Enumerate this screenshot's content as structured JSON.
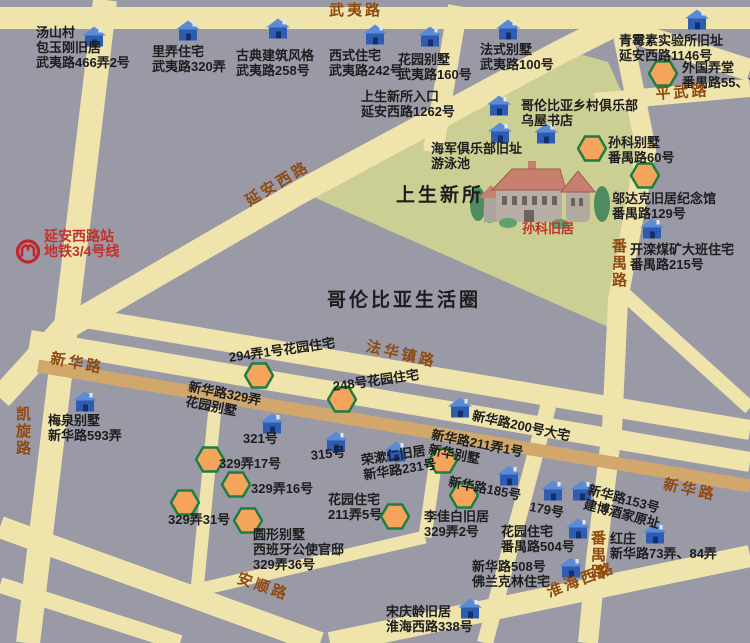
{
  "colors": {
    "background": "#9a9aa7",
    "road": "#f0e4ad",
    "xinhua_road": "#d2a76b",
    "park": "#cccf93",
    "road_label": "#8f4a10",
    "poi_label": "#1d1d1d",
    "red_label": "#c0312b",
    "house_blue": "#2e5cb0",
    "house_roof": "#5b8ad6",
    "hexagon_fill": "#f5a45c",
    "hexagon_border": "#1c7f41",
    "metro_red": "#c0272d",
    "illustration_roof": "#c8806e",
    "illustration_wall": "#b7aea6",
    "tree_green": "#4e8b5f"
  },
  "map": {
    "labels": [
      {
        "name": "poi-baoyugang",
        "lines": [
          "汤山村",
          "包玉刚旧居",
          "武夷路466弄2号"
        ],
        "x": 36,
        "y": 25,
        "kind": "poi"
      },
      {
        "name": "poi-lilong",
        "lines": [
          "里弄住宅",
          "武夷路320弄"
        ],
        "x": 152,
        "y": 44,
        "kind": "poi"
      },
      {
        "name": "poi-gudian",
        "lines": [
          "古典建筑风格",
          "武夷路258号"
        ],
        "x": 236,
        "y": 48,
        "kind": "poi"
      },
      {
        "name": "poi-xishi",
        "lines": [
          "西式住宅",
          "武夷路242号"
        ],
        "x": 329,
        "y": 48,
        "kind": "poi"
      },
      {
        "name": "poi-huayuan-160",
        "lines": [
          "花园别墅",
          "武夷路160号"
        ],
        "x": 398,
        "y": 52,
        "kind": "poi"
      },
      {
        "name": "poi-fashi",
        "lines": [
          "法式别墅",
          "武夷路100号"
        ],
        "x": 480,
        "y": 42,
        "kind": "poi"
      },
      {
        "name": "poi-qingmeisu",
        "lines": [
          "青霉素实验所旧址",
          "延安西路1146号"
        ],
        "x": 619,
        "y": 33,
        "kind": "poi"
      },
      {
        "name": "poi-waiguo-longtang",
        "lines": [
          "外国弄堂",
          "番禺路55、7"
        ],
        "x": 682,
        "y": 60,
        "kind": "poi"
      },
      {
        "name": "poi-entrance",
        "lines": [
          "上生新所入口",
          "延安西路1262号"
        ],
        "x": 361,
        "y": 89,
        "kind": "poi"
      },
      {
        "name": "poi-columbia-club",
        "lines": [
          "哥伦比亚乡村俱乐部",
          "乌屋书店"
        ],
        "x": 521,
        "y": 98,
        "kind": "poi"
      },
      {
        "name": "poi-navy-club",
        "lines": [
          "海军俱乐部旧址",
          "游泳池"
        ],
        "x": 431,
        "y": 141,
        "kind": "poi"
      },
      {
        "name": "poi-sunke-villa",
        "lines": [
          "孙科别墅",
          "番禺路60号"
        ],
        "x": 608,
        "y": 135,
        "kind": "poi"
      },
      {
        "name": "poi-wudake",
        "lines": [
          "邬达克旧居纪念馆",
          "番禺路129号"
        ],
        "x": 612,
        "y": 191,
        "kind": "poi"
      },
      {
        "name": "poi-kailuan",
        "lines": [
          "开滦煤矿大班住宅",
          "番禺路215号"
        ],
        "x": 630,
        "y": 242,
        "kind": "poi"
      },
      {
        "name": "poi-meiquan",
        "lines": [
          "梅泉别墅",
          "新华路593弄"
        ],
        "x": 48,
        "y": 413,
        "kind": "poi"
      },
      {
        "name": "poi-294-1",
        "lines": [
          "294弄1号花园住宅"
        ],
        "x": 228,
        "y": 350,
        "kind": "poi",
        "rotate": -8
      },
      {
        "name": "poi-248",
        "lines": [
          "248号花园住宅"
        ],
        "x": 332,
        "y": 379,
        "kind": "poi",
        "rotate": -8
      },
      {
        "name": "poi-329nong",
        "lines": [
          "新华路329弄",
          "花园别墅"
        ],
        "x": 190,
        "y": 379,
        "kind": "poi",
        "rotate": 11
      },
      {
        "name": "poi-321",
        "lines": [
          "321号"
        ],
        "x": 243,
        "y": 431,
        "kind": "poi"
      },
      {
        "name": "poi-315",
        "lines": [
          "315号"
        ],
        "x": 310,
        "y": 448,
        "kind": "poi",
        "rotate": -6
      },
      {
        "name": "poi-rongshuren",
        "lines": [
          "荣漱仁旧居",
          "新华路231号"
        ],
        "x": 360,
        "y": 453,
        "kind": "poi",
        "rotate": -9
      },
      {
        "name": "poi-329-17",
        "lines": [
          "329弄17号"
        ],
        "x": 219,
        "y": 456,
        "kind": "poi"
      },
      {
        "name": "poi-329-16",
        "lines": [
          "329弄16号"
        ],
        "x": 251,
        "y": 481,
        "kind": "poi"
      },
      {
        "name": "poi-329-31",
        "lines": [
          "329弄31号"
        ],
        "x": 168,
        "y": 512,
        "kind": "poi"
      },
      {
        "name": "poi-329-36",
        "lines": [
          "圆形别墅",
          "西班牙公使官邸",
          "329弄36号"
        ],
        "x": 253,
        "y": 527,
        "kind": "poi"
      },
      {
        "name": "poi-211-5",
        "lines": [
          "花园住宅",
          "211弄5号"
        ],
        "x": 328,
        "y": 492,
        "kind": "poi"
      },
      {
        "name": "poi-lijiabai",
        "lines": [
          "李佳白旧居",
          "329弄2号"
        ],
        "x": 424,
        "y": 509,
        "kind": "poi"
      },
      {
        "name": "poi-xinhua-villa",
        "lines": [
          "新华路211弄1号",
          "新华别墅"
        ],
        "x": 433,
        "y": 427,
        "kind": "poi",
        "rotate": 11
      },
      {
        "name": "poi-185",
        "lines": [
          "新华路185号"
        ],
        "x": 450,
        "y": 474,
        "kind": "poi",
        "rotate": 11
      },
      {
        "name": "poi-179",
        "lines": [
          "179号"
        ],
        "x": 531,
        "y": 499,
        "kind": "poi",
        "rotate": 11
      },
      {
        "name": "poi-153",
        "lines": [
          "新华路153号",
          "建博酒家原址"
        ],
        "x": 590,
        "y": 482,
        "kind": "poi",
        "rotate": 15
      },
      {
        "name": "poi-hongzhuang",
        "lines": [
          "红庄",
          "新华路73弄、84弄"
        ],
        "x": 610,
        "y": 531,
        "kind": "poi"
      },
      {
        "name": "poi-504",
        "lines": [
          "花园住宅",
          "番禺路504号"
        ],
        "x": 501,
        "y": 524,
        "kind": "poi"
      },
      {
        "name": "poi-508",
        "lines": [
          "新华路508号",
          "佛兰克林住宅"
        ],
        "x": 472,
        "y": 559,
        "kind": "poi"
      },
      {
        "name": "poi-songqingling",
        "lines": [
          "宋庆龄旧居",
          "淮海西路338号"
        ],
        "x": 386,
        "y": 604,
        "kind": "poi"
      },
      {
        "name": "poi-200",
        "lines": [
          "新华路200号大宅"
        ],
        "x": 474,
        "y": 408,
        "kind": "poi",
        "rotate": 12
      },
      {
        "name": "sunke-house-caption",
        "lines": [
          "孙科旧居"
        ],
        "x": 522,
        "y": 221,
        "kind": "red",
        "size": 13
      },
      {
        "name": "metro-station-label",
        "lines": [
          "延安西路站",
          "地铁3/4号线"
        ],
        "x": 44,
        "y": 229,
        "kind": "red",
        "size": 14
      },
      {
        "name": "area-title-shangsheng",
        "lines": [
          "上生新所"
        ],
        "x": 396,
        "y": 185,
        "kind": "title"
      },
      {
        "name": "area-title-columbia",
        "lines": [
          "哥伦比亚生活圈"
        ],
        "x": 327,
        "y": 290,
        "kind": "title"
      },
      {
        "name": "road-wuyi-label",
        "lines": [
          "武夷路"
        ],
        "x": 329,
        "y": 3,
        "kind": "road"
      },
      {
        "name": "road-pingwu-label",
        "lines": [
          "平武路"
        ],
        "x": 655,
        "y": 87,
        "kind": "road",
        "rotate": -4
      },
      {
        "name": "road-yanan-label",
        "lines": [
          "延安西路"
        ],
        "x": 243,
        "y": 196,
        "kind": "road",
        "rotate": -31
      },
      {
        "name": "road-fahuazhen-label",
        "lines": [
          "法华镇路"
        ],
        "x": 368,
        "y": 339,
        "kind": "road",
        "rotate": 13
      },
      {
        "name": "road-xinhua-left-label",
        "lines": [
          "新华路"
        ],
        "x": 52,
        "y": 351,
        "kind": "road",
        "rotate": 11
      },
      {
        "name": "road-kaixuan-label",
        "lines": [
          "凯旋路"
        ],
        "x": 14,
        "y": 406,
        "kind": "road",
        "vertical": true
      },
      {
        "name": "road-panyu-north-label",
        "lines": [
          "番禺路"
        ],
        "x": 610,
        "y": 238,
        "kind": "road",
        "vertical": true
      },
      {
        "name": "road-panyu-south-label",
        "lines": [
          "番禺路"
        ],
        "x": 589,
        "y": 530,
        "kind": "road",
        "vertical": true
      },
      {
        "name": "road-xinhua-right-label",
        "lines": [
          "新华路"
        ],
        "x": 665,
        "y": 477,
        "kind": "road",
        "rotate": 12
      },
      {
        "name": "road-anshun-label",
        "lines": [
          "安顺路"
        ],
        "x": 240,
        "y": 571,
        "kind": "road",
        "rotate": 19
      },
      {
        "name": "road-huaihai-label",
        "lines": [
          "淮海西路"
        ],
        "x": 545,
        "y": 586,
        "kind": "road",
        "rotate": -21
      }
    ],
    "markers": [
      {
        "kind": "house",
        "x": 94,
        "y": 39
      },
      {
        "kind": "house",
        "x": 188,
        "y": 33
      },
      {
        "kind": "house",
        "x": 278,
        "y": 31
      },
      {
        "kind": "house",
        "x": 375,
        "y": 37
      },
      {
        "kind": "house",
        "x": 430,
        "y": 39
      },
      {
        "kind": "house",
        "x": 508,
        "y": 32
      },
      {
        "kind": "house",
        "x": 697,
        "y": 22
      },
      {
        "kind": "house",
        "x": 499,
        "y": 108
      },
      {
        "kind": "house",
        "x": 500,
        "y": 135
      },
      {
        "kind": "house",
        "x": 546,
        "y": 136
      },
      {
        "kind": "house",
        "x": 652,
        "y": 231
      },
      {
        "kind": "house",
        "x": 85,
        "y": 404
      },
      {
        "kind": "house",
        "x": 460,
        "y": 410
      },
      {
        "kind": "house",
        "x": 272,
        "y": 426
      },
      {
        "kind": "house",
        "x": 336,
        "y": 444
      },
      {
        "kind": "house",
        "x": 396,
        "y": 454
      },
      {
        "kind": "house",
        "x": 509,
        "y": 478
      },
      {
        "kind": "house",
        "x": 553,
        "y": 493
      },
      {
        "kind": "house",
        "x": 582,
        "y": 493
      },
      {
        "kind": "house",
        "x": 578,
        "y": 531
      },
      {
        "kind": "house",
        "x": 655,
        "y": 536
      },
      {
        "kind": "house",
        "x": 571,
        "y": 570
      },
      {
        "kind": "house",
        "x": 470,
        "y": 611
      },
      {
        "kind": "hexagon",
        "x": 663,
        "y": 76
      },
      {
        "kind": "hexagon",
        "x": 592,
        "y": 151
      },
      {
        "kind": "hexagon",
        "x": 645,
        "y": 178
      },
      {
        "kind": "hexagon",
        "x": 259,
        "y": 378
      },
      {
        "kind": "hexagon",
        "x": 342,
        "y": 402
      },
      {
        "kind": "hexagon",
        "x": 210,
        "y": 462
      },
      {
        "kind": "hexagon",
        "x": 236,
        "y": 487
      },
      {
        "kind": "hexagon",
        "x": 185,
        "y": 505
      },
      {
        "kind": "hexagon",
        "x": 248,
        "y": 523
      },
      {
        "kind": "hexagon",
        "x": 395,
        "y": 519
      },
      {
        "kind": "hexagon",
        "x": 464,
        "y": 498
      },
      {
        "kind": "hexagon",
        "x": 443,
        "y": 463
      },
      {
        "kind": "metro",
        "x": 28,
        "y": 254
      }
    ]
  }
}
